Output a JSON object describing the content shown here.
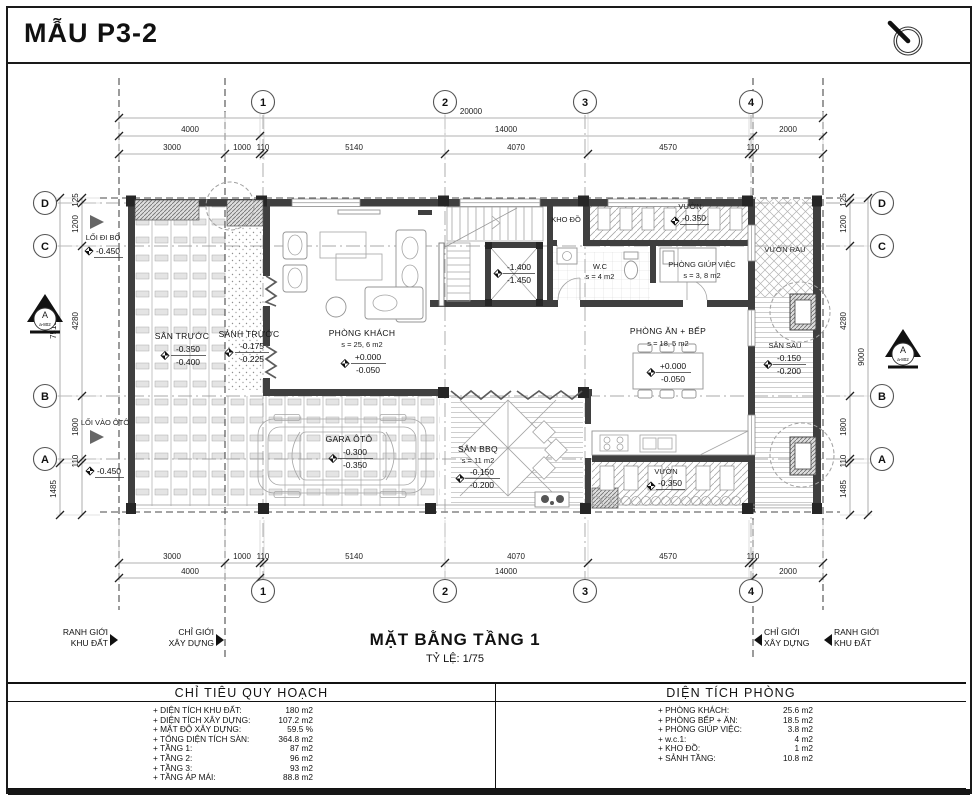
{
  "sheet": {
    "title": "MẪU P3-2",
    "plan_title": "MẶT BẰNG TẦNG 1",
    "plan_scale": "TỶ LỆ: 1/75"
  },
  "icons": {
    "compass": "north-compass"
  },
  "grid": {
    "cols": [
      "1",
      "2",
      "3",
      "4"
    ],
    "rows": [
      "D",
      "C",
      "B",
      "A"
    ]
  },
  "section_marker": {
    "label": "A",
    "ref": "a-802"
  },
  "dims": {
    "top_total": "20000",
    "top_mid": [
      "4000",
      "14000",
      "2000"
    ],
    "top_inner": [
      "3000",
      "1000",
      "110",
      "5140",
      "4070",
      "4570",
      "110"
    ],
    "bottom_inner": [
      "3000",
      "1000",
      "110",
      "5140",
      "4070",
      "4570",
      "110"
    ],
    "bottom_mid": [
      "4000",
      "14000",
      "2000"
    ],
    "left_inner": [
      "125",
      "1200",
      "4280",
      "1800",
      "110"
    ],
    "left_outer": [
      "7515",
      "1485"
    ],
    "right_inner": [
      "125",
      "1200",
      "4280",
      "1800",
      "110",
      "1485"
    ],
    "right_outer": [
      "9000"
    ]
  },
  "boundaries": {
    "site": [
      "RANH GIỚI",
      "KHU ĐẤT"
    ],
    "build": [
      "CHỈ GIỚI",
      "XÂY DỰNG"
    ]
  },
  "access": {
    "walk": {
      "label": "LỐI ĐI BỘ",
      "level": "-0.450"
    },
    "car": {
      "label": "LỐI VÀO ÔTÔ",
      "level": "-0.450"
    }
  },
  "rooms": {
    "san_truoc": {
      "name": "SÂN TRƯỚC",
      "lv1": "-0.350",
      "lv2": "-0.400"
    },
    "sanh_truoc": {
      "name": "SẢNH TRƯỚC",
      "lv1": "-0.175",
      "lv2": "-0.225"
    },
    "phong_khach": {
      "name": "PHÒNG KHÁCH",
      "area": "s = 25, 6 m2",
      "lv1": "+0.000",
      "lv2": "-0.050"
    },
    "kho_do": {
      "name": "KHO ĐỒ"
    },
    "vuon_top": {
      "name": "VƯỜN",
      "lv1": "-0.350"
    },
    "wc": {
      "name": "W.C",
      "area": "s = 4 m2"
    },
    "phong_giup_viec": {
      "name": "PHÒNG GIÚP VIỆC",
      "area": "s = 3, 8 m2"
    },
    "phong_an_bep": {
      "name": "PHÒNG ĂN + BẾP",
      "area": "s = 18, 5 m2",
      "lv1": "+0.000",
      "lv2": "-0.050"
    },
    "thang_may": {
      "lv1": "-1.400",
      "lv2": "-1.450"
    },
    "gara": {
      "name": "GARA ÔTÔ",
      "lv1": "-0.300",
      "lv2": "-0.350"
    },
    "san_bbq": {
      "name": "SÂN BBQ",
      "area": "s = 11 m2",
      "lv1": "-0.150",
      "lv2": "-0.200"
    },
    "vuon_bottom": {
      "name": "VƯỜN",
      "lv1": "-0.350"
    },
    "vuon_rau": {
      "name": "VƯỜN RAU"
    },
    "san_sau": {
      "name": "SÂN SAU",
      "lv1": "-0.150",
      "lv2": "-0.200"
    }
  },
  "table_left": {
    "title": "CHỈ TIÊU QUY HOẠCH",
    "rows": [
      {
        "label": "+ DIỆN TÍCH KHU ĐẤT:",
        "value": "180 m2"
      },
      {
        "label": "+ DIỆN TÍCH XÂY DỰNG:",
        "value": "107.2 m2"
      },
      {
        "label": "+ MẬT ĐỘ XÂY DỰNG:",
        "value": "59.5 %"
      },
      {
        "label": "+ TỔNG DIỆN TÍCH SÀN:",
        "value": "364.8 m2"
      },
      {
        "label": "+ TẦNG 1:",
        "value": "87 m2"
      },
      {
        "label": "+ TẦNG 2:",
        "value": "96 m2"
      },
      {
        "label": "+ TẦNG 3:",
        "value": "93 m2"
      },
      {
        "label": "+ TẦNG ÁP MÁI:",
        "value": "88.8 m2"
      }
    ]
  },
  "table_right": {
    "title": "DIỆN TÍCH PHÒNG",
    "rows": [
      {
        "label": "+ PHÒNG KHÁCH:",
        "value": "25.6 m2"
      },
      {
        "label": "+ PHÒNG BẾP + ĂN:",
        "value": "18.5 m2"
      },
      {
        "label": "+ PHÒNG GIÚP VIỆC:",
        "value": "3.8 m2"
      },
      {
        "label": "+ w.c.1:",
        "value": "4 m2"
      },
      {
        "label": "+ KHO ĐỒ:",
        "value": "1 m2"
      },
      {
        "label": "+ SẢNH TẦNG:",
        "value": "10.8 m2"
      }
    ]
  }
}
